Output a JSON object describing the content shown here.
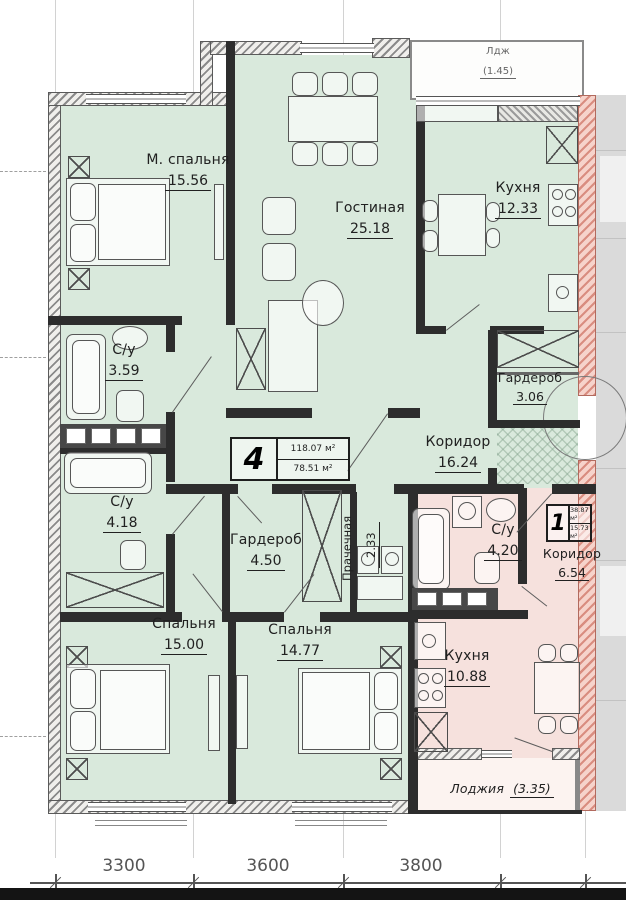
{
  "plan": {
    "apt4": {
      "stamp_number": "4",
      "stamp_total": "118.07 м²",
      "stamp_living": "78.51 м²",
      "master_bedroom": {
        "name": "М. спальня",
        "area": "15.56"
      },
      "living": {
        "name": "Гостиная",
        "area": "25.18"
      },
      "kitchen": {
        "name": "Кухня",
        "area": "12.33"
      },
      "bath1": {
        "name": "С/у",
        "area": "3.59"
      },
      "bath2": {
        "name": "С/у",
        "area": "4.18"
      },
      "wardrobe1": {
        "name": "Гардероб",
        "area": "3.06"
      },
      "corridor": {
        "name": "Коридор",
        "area": "16.24"
      },
      "wardrobe2": {
        "name": "Гардероб",
        "area": "4.50"
      },
      "laundry": {
        "name": "Прачечная",
        "area": "2.33"
      },
      "bedroom2": {
        "name": "Спальня",
        "area": "15.00"
      },
      "bedroom3": {
        "name": "Спальня",
        "area": "14.77"
      },
      "balcony": {
        "name": "Лдж",
        "area": "(1.45)"
      }
    },
    "apt1": {
      "stamp_number": "1",
      "stamp_total": "38.87 м²",
      "stamp_living": "15.73 м²",
      "bath": {
        "name": "С/у",
        "area": "4.20"
      },
      "corridor": {
        "name": "Коридор",
        "area": "6.54"
      },
      "kitchen": {
        "name": "Кухня",
        "area": "10.88"
      },
      "loggia": {
        "name": "Лоджия",
        "area": "(3.35)"
      }
    },
    "dimensions": {
      "d1": "3300",
      "d2": "3600",
      "d3": "3800"
    }
  }
}
